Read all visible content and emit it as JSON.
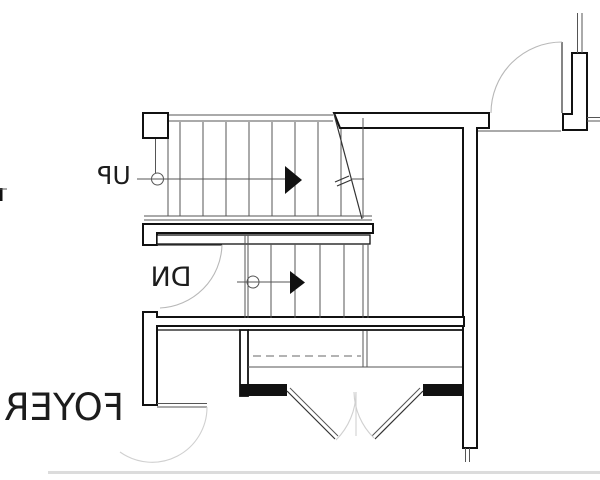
{
  "plan": {
    "labels": {
      "up": "UP",
      "dn": "DN",
      "foyer": "FOYER"
    },
    "text_style": {
      "mirrored": true
    },
    "colors": {
      "wall_line": "#111111",
      "thin_line": "#555555",
      "door_arc": "#b8b8b8",
      "faint_arc": "#d0d0d0",
      "dashed_line": "#9a9a9a",
      "text": "#1c1c1c",
      "scan_band": "#dcdcdc",
      "background": "#ffffff"
    }
  }
}
